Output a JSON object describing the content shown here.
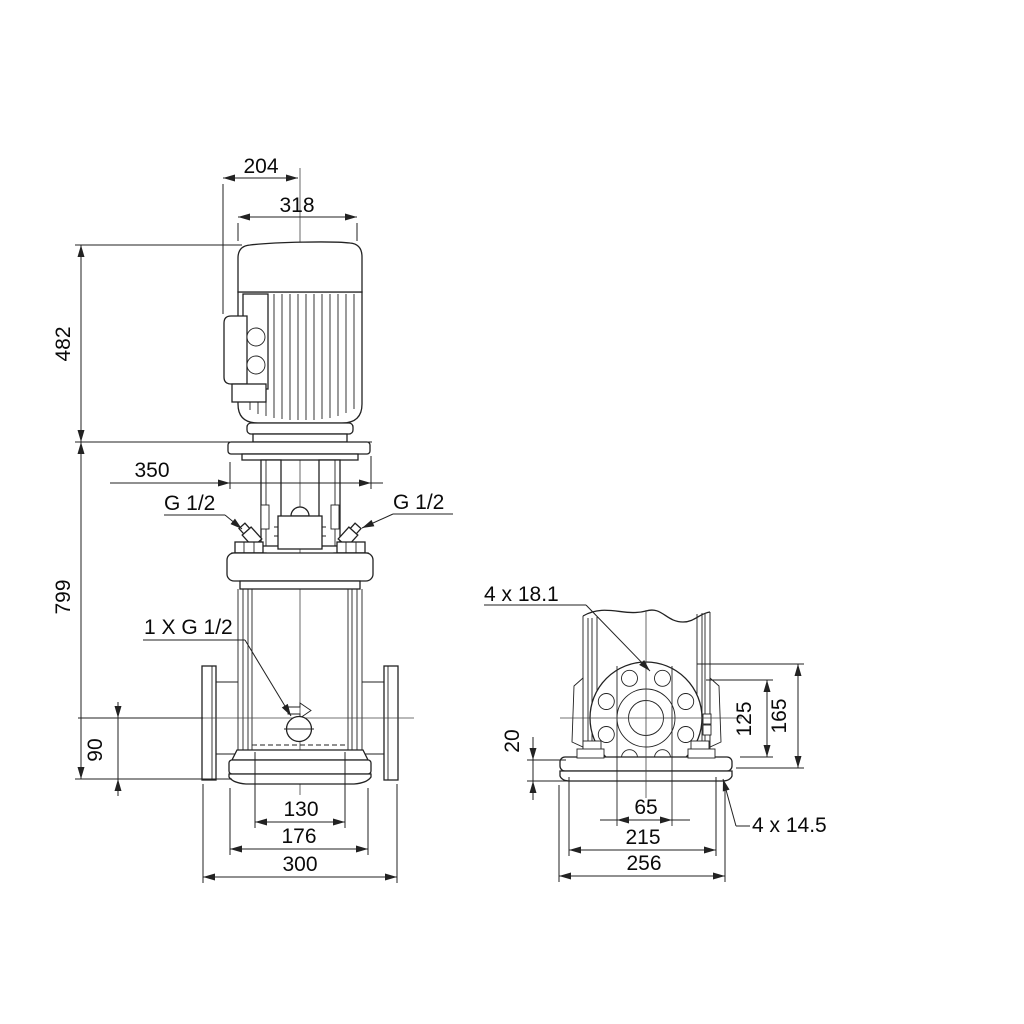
{
  "drawing_title": "pump-dimensional-drawing",
  "colors": {
    "line": "#222222",
    "text": "#0a0a0a",
    "background": "#ffffff"
  },
  "front": {
    "d204": "204",
    "d318": "318",
    "d482": "482",
    "d350": "350",
    "d799": "799",
    "d90": "90",
    "d130": "130",
    "d176": "176",
    "d300": "300",
    "g_left": "G 1/2",
    "g_right": "G 1/2",
    "drain": "1 X G 1/2"
  },
  "side": {
    "holes_top": "4 x 18.1",
    "d20": "20",
    "d125": "125",
    "d165": "165",
    "d65": "65",
    "d215": "215",
    "d256": "256",
    "holes_base": "4 x 14.5"
  }
}
